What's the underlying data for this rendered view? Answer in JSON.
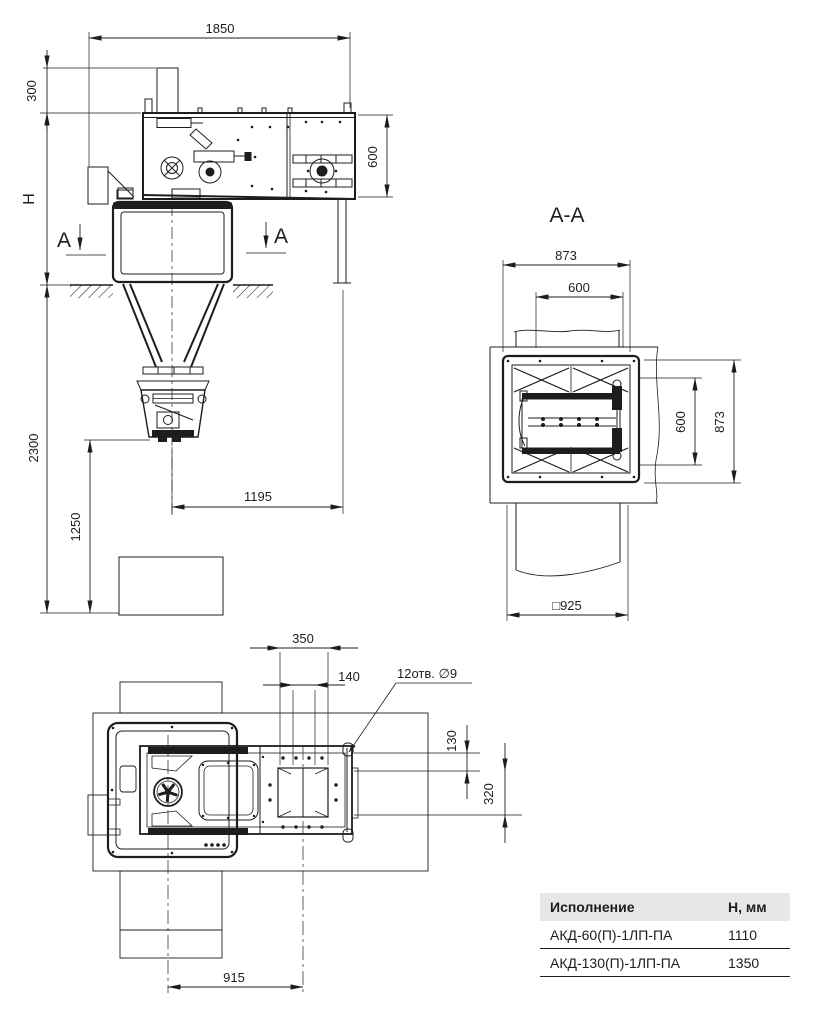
{
  "colors": {
    "line": "#1d1d1d",
    "table_header_bg": "#e7e7e7",
    "background": "#ffffff"
  },
  "elevation_view": {
    "dims": {
      "overall_width": "1850",
      "inlet_height": "300",
      "height_to_ground": "H",
      "body_height": "600",
      "pit_depth": "2300",
      "discharge_clearance": "1250",
      "discharge_offset": "1195"
    },
    "section_marks": {
      "left": "A",
      "right": "A"
    }
  },
  "section_view": {
    "title": "A-A",
    "dims": {
      "frame_width": "873",
      "opening_width": "600",
      "opening_height": "600",
      "frame_height": "873",
      "slab_opening": "□925"
    }
  },
  "plan_view": {
    "dims": {
      "flange_span": "350",
      "outlet_width": "140",
      "row_offset": "130",
      "outlet_length": "320",
      "center_distance": "915"
    },
    "callout": "12отв. ∅9"
  },
  "spec_table": {
    "headers": [
      "Исполнение",
      "Н, мм"
    ],
    "rows": [
      {
        "model": "АКД-60(П)-1ЛП-ПА",
        "h_mm": "1110"
      },
      {
        "model": "АКД-130(П)-1ЛП-ПА",
        "h_mm": "1350"
      }
    ]
  }
}
